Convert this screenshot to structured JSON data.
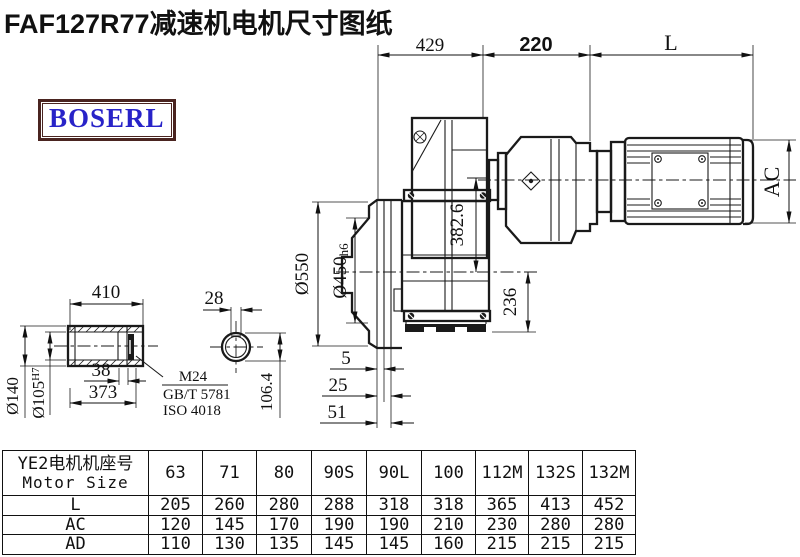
{
  "title": "FAF127R77减速机电机尺寸图纸",
  "brand": {
    "name": "BOSERL",
    "text_color": "#2823c8",
    "border_color": "#4a2420"
  },
  "drawing": {
    "line_color": "#1a1a1a",
    "dims": {
      "width_429": "429",
      "width_220": "220",
      "width_L": "L",
      "motor_AC": "AC",
      "flange_od": "Ø550",
      "spigot_d": "Ø450",
      "spigot_tol": "h6",
      "axis_height": "382.6",
      "shaft_height": "236",
      "off_5": "5",
      "off_25": "25",
      "off_51": "51",
      "shaft_len": "410",
      "shaft_38": "38",
      "shaft_373": "373",
      "hub_od": "Ø140",
      "bore_d": "Ø105",
      "bore_tol": "H7",
      "callout_m24": "M24",
      "callout_gbt": "GB/T 5781",
      "callout_iso": "ISO 4018",
      "key_w": "28",
      "key_h": "106.4"
    }
  },
  "table": {
    "header_cn": "YE2电机机座号",
    "header_en": "Motor Size",
    "frame_sizes": [
      "63",
      "71",
      "80",
      "90S",
      "90L",
      "100",
      "112M",
      "132S",
      "132M"
    ],
    "rows": [
      {
        "label": "L",
        "values": [
          "205",
          "260",
          "280",
          "288",
          "318",
          "318",
          "365",
          "413",
          "452"
        ]
      },
      {
        "label": "AC",
        "values": [
          "120",
          "145",
          "170",
          "190",
          "190",
          "210",
          "230",
          "280",
          "280"
        ]
      },
      {
        "label": "AD",
        "values": [
          "110",
          "130",
          "135",
          "145",
          "145",
          "160",
          "215",
          "215",
          "215"
        ]
      }
    ]
  }
}
